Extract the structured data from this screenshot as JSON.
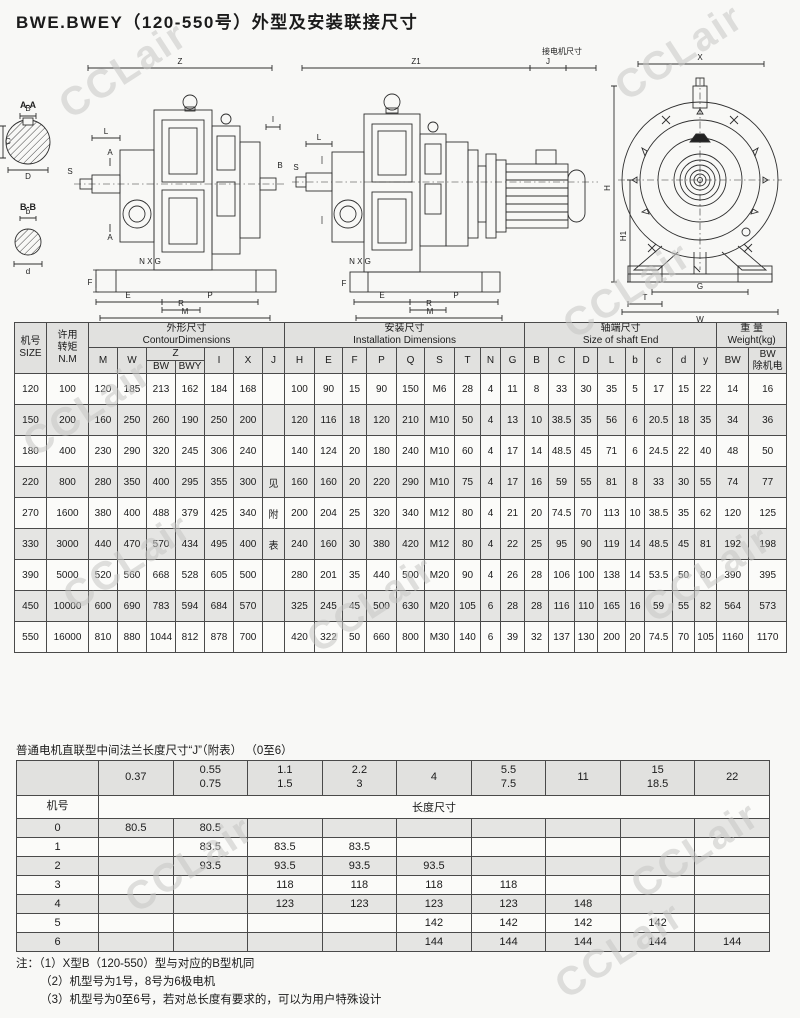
{
  "page": {
    "title": "BWE.BWEY（120-550号）外型及安装联接尺寸"
  },
  "watermark": {
    "text": "CCLair",
    "color": "#c7c7c5"
  },
  "drawings": {
    "left": {
      "dim_top": "Z",
      "sec_a": "A-A",
      "sec_b": "B-B",
      "lbl_B": "B",
      "lbl_C": "C",
      "lbl_D": "D",
      "lbl_b": "b",
      "lbl_d": "d",
      "lbl_L": "L",
      "lbl_A1": "A",
      "lbl_A2": "A",
      "lbl_S": "S",
      "lbl_I": "I",
      "lbl_Br": "B",
      "lbl_NXG": "N X G",
      "lbl_F": "F",
      "lbl_E": "E",
      "lbl_P": "P",
      "lbl_R": "R",
      "lbl_M": "M"
    },
    "middle": {
      "dim_top": "Z1",
      "dim_j": "J",
      "dim_motor": "接电机尺寸",
      "lbl_L": "L",
      "lbl_S": "S",
      "lbl_NXG": "N X G",
      "lbl_F": "F",
      "lbl_E": "E",
      "lbl_P": "P",
      "lbl_R": "R",
      "lbl_M": "M"
    },
    "right": {
      "dim_x": "X",
      "dim_h": "H",
      "dim_h1": "H1",
      "dim_g": "G",
      "dim_t": "T",
      "dim_w": "W"
    }
  },
  "table1": {
    "h_size": "机号\nSIZE",
    "h_torque": "许用\n转矩\nN.M",
    "g_contour": "外形尺寸\nContourDimensions",
    "g_install": "安装尺寸\nInstallation  Dimensions",
    "g_shaft": "轴端尺寸\nSize of shaft End",
    "g_weight": "重 量\nWeight(kg)",
    "h_M": "M",
    "h_W": "W",
    "h_Z": "Z",
    "h_BW": "BW",
    "h_BWY": "BWY",
    "h_I": "I",
    "h_X": "X",
    "h_J": "J",
    "h_H": "H",
    "h_E": "E",
    "h_F": "F",
    "h_P": "P",
    "h_Q": "Q",
    "h_S": "S",
    "h_T": "T",
    "h_N": "N",
    "h_G": "G",
    "h_B2": "B",
    "h_C2": "C",
    "h_D2": "D",
    "h_L2": "L",
    "h_b": "b",
    "h_c": "c",
    "h_d": "d",
    "h_y": "y",
    "h_BW1": "BW",
    "h_BW2": "BW\n除机电",
    "rows": [
      [
        "120",
        "100",
        "120",
        "185",
        "213",
        "162",
        "184",
        "168",
        "",
        "100",
        "90",
        "15",
        "90",
        "150",
        "M6",
        "28",
        "4",
        "11",
        "8",
        "33",
        "30",
        "35",
        "5",
        "17",
        "15",
        "22",
        "14",
        "16"
      ],
      [
        "150",
        "200",
        "160",
        "250",
        "260",
        "190",
        "250",
        "200",
        "",
        "120",
        "116",
        "18",
        "120",
        "210",
        "M10",
        "50",
        "4",
        "13",
        "10",
        "38.5",
        "35",
        "56",
        "6",
        "20.5",
        "18",
        "35",
        "34",
        "36"
      ],
      [
        "180",
        "400",
        "230",
        "290",
        "320",
        "245",
        "306",
        "240",
        "",
        "140",
        "124",
        "20",
        "180",
        "240",
        "M10",
        "60",
        "4",
        "17",
        "14",
        "48.5",
        "45",
        "71",
        "6",
        "24.5",
        "22",
        "40",
        "48",
        "50"
      ],
      [
        "220",
        "800",
        "280",
        "350",
        "400",
        "295",
        "355",
        "300",
        "见",
        "160",
        "160",
        "20",
        "220",
        "290",
        "M10",
        "75",
        "4",
        "17",
        "16",
        "59",
        "55",
        "81",
        "8",
        "33",
        "30",
        "55",
        "74",
        "77"
      ],
      [
        "270",
        "1600",
        "380",
        "400",
        "488",
        "379",
        "425",
        "340",
        "附",
        "200",
        "204",
        "25",
        "320",
        "340",
        "M12",
        "80",
        "4",
        "21",
        "20",
        "74.5",
        "70",
        "113",
        "10",
        "38.5",
        "35",
        "62",
        "120",
        "125"
      ],
      [
        "330",
        "3000",
        "440",
        "470",
        "570",
        "434",
        "495",
        "400",
        "表",
        "240",
        "160",
        "30",
        "380",
        "420",
        "M12",
        "80",
        "4",
        "22",
        "25",
        "95",
        "90",
        "119",
        "14",
        "48.5",
        "45",
        "81",
        "192",
        "198"
      ],
      [
        "390",
        "5000",
        "520",
        "560",
        "668",
        "528",
        "605",
        "500",
        "",
        "280",
        "201",
        "35",
        "440",
        "500",
        "M20",
        "90",
        "4",
        "26",
        "28",
        "106",
        "100",
        "138",
        "14",
        "53.5",
        "50",
        "80",
        "390",
        "395"
      ],
      [
        "450",
        "10000",
        "600",
        "690",
        "783",
        "594",
        "684",
        "570",
        "",
        "325",
        "245",
        "45",
        "500",
        "630",
        "M20",
        "105",
        "6",
        "28",
        "28",
        "116",
        "110",
        "165",
        "16",
        "59",
        "55",
        "82",
        "564",
        "573"
      ],
      [
        "550",
        "16000",
        "810",
        "880",
        "1044",
        "812",
        "878",
        "700",
        "",
        "420",
        "322",
        "50",
        "660",
        "800",
        "M30",
        "140",
        "6",
        "39",
        "32",
        "137",
        "130",
        "200",
        "20",
        "74.5",
        "70",
        "105",
        "1160",
        "1170"
      ]
    ]
  },
  "table2": {
    "title": "普通电机直联型中间法兰长度尺寸“J”（附表）  （0至6）",
    "corner": "",
    "power_cols": [
      "0.37",
      "0.55\n0.75",
      "1.1\n1.5",
      "2.2\n3",
      "4",
      "5.5\n7.5",
      "11",
      "15\n18.5",
      "22"
    ],
    "row_label": "机号",
    "span_label": "长度尺寸",
    "rows": [
      {
        "id": "0",
        "v": [
          "80.5",
          "80.5",
          "",
          "",
          "",
          "",
          "",
          "",
          ""
        ]
      },
      {
        "id": "1",
        "v": [
          "",
          "83.5",
          "83.5",
          "83.5",
          "",
          "",
          "",
          "",
          ""
        ]
      },
      {
        "id": "2",
        "v": [
          "",
          "93.5",
          "93.5",
          "93.5",
          "93.5",
          "",
          "",
          "",
          ""
        ]
      },
      {
        "id": "3",
        "v": [
          "",
          "",
          "118",
          "118",
          "118",
          "118",
          "",
          "",
          ""
        ]
      },
      {
        "id": "4",
        "v": [
          "",
          "",
          "123",
          "123",
          "123",
          "123",
          "148",
          "",
          ""
        ]
      },
      {
        "id": "5",
        "v": [
          "",
          "",
          "",
          "",
          "142",
          "142",
          "142",
          "142",
          ""
        ]
      },
      {
        "id": "6",
        "v": [
          "",
          "",
          "",
          "",
          "144",
          "144",
          "144",
          "144",
          "144"
        ]
      }
    ]
  },
  "notes": [
    "注：（1）X型B（120-550）型与对应的B型机同",
    "（2）机型号为1号，8号为6极电机",
    "（3）机型号为0至6号，若对总长度有要求的，可以为用户特殊设计"
  ]
}
